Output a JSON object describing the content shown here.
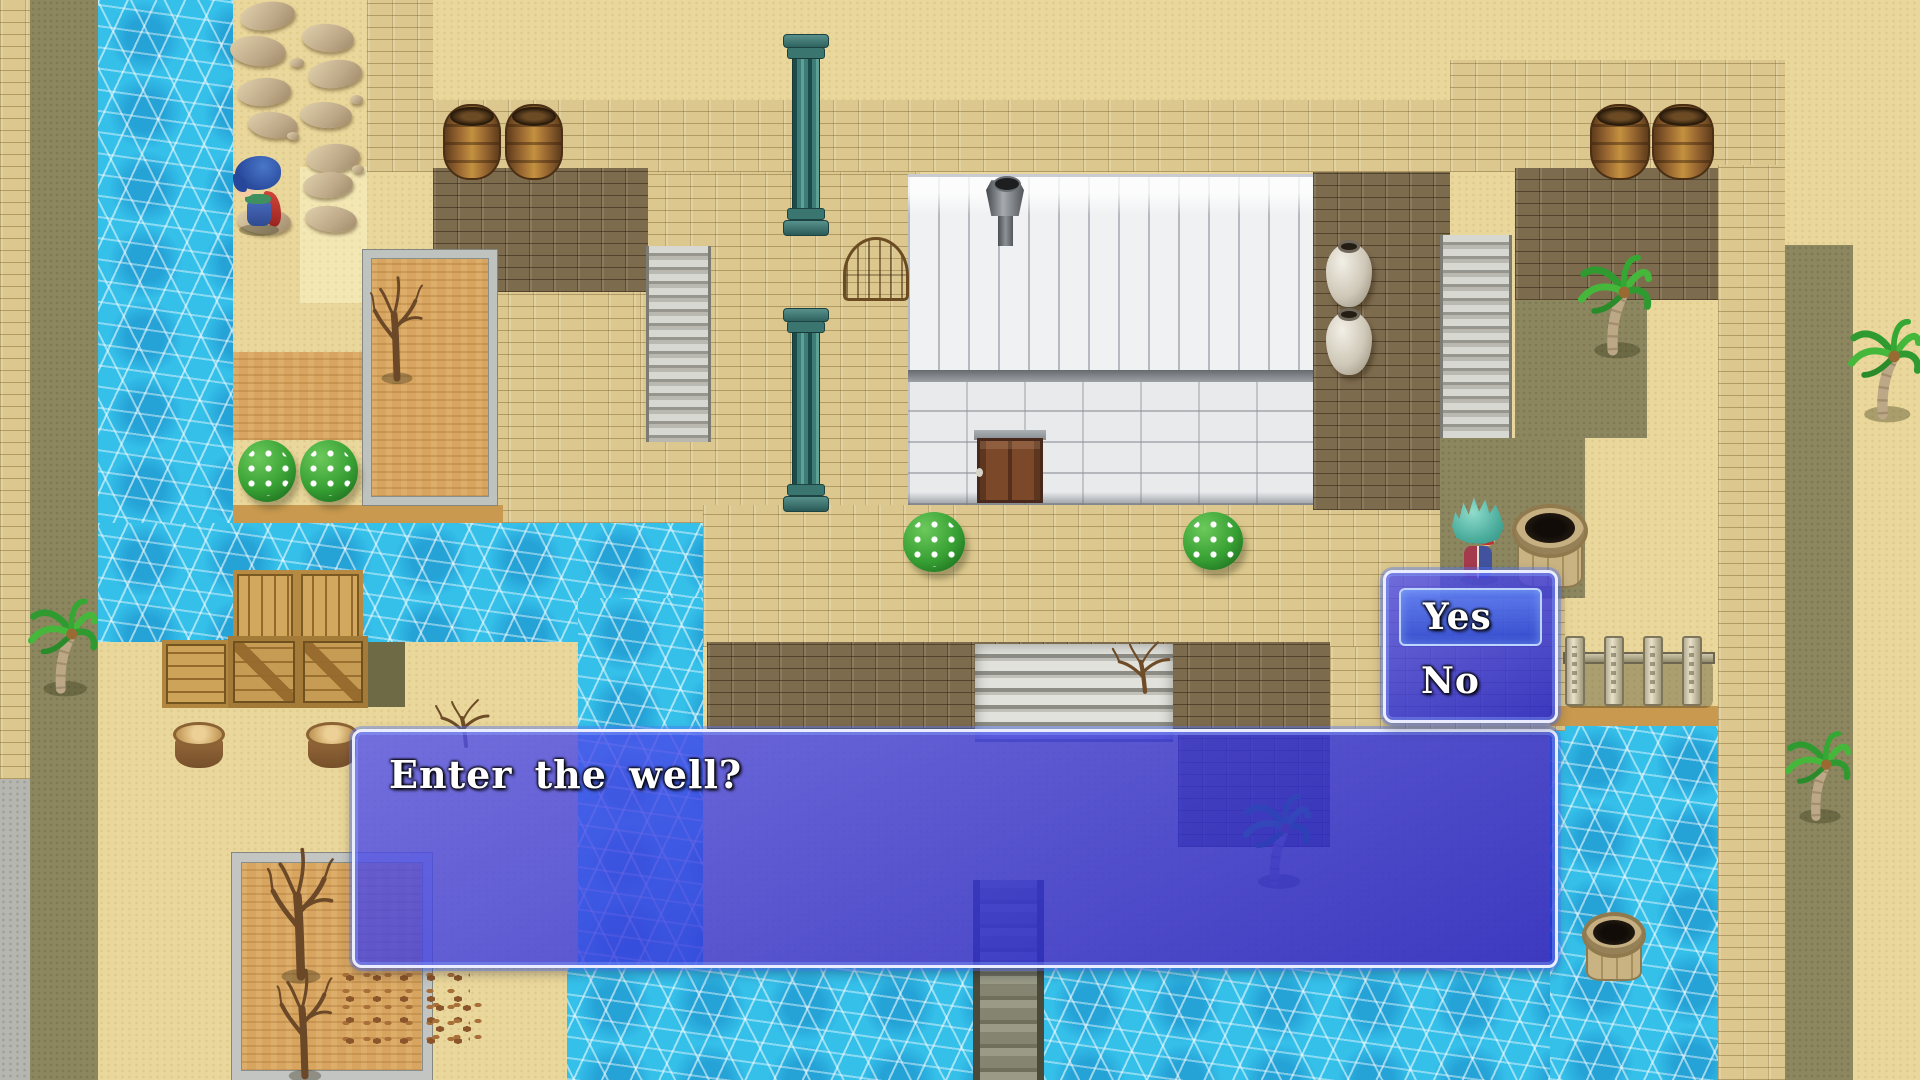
{
  "game": {
    "message_window": {
      "text": "Enter the well?"
    },
    "choice_window": {
      "options": [
        {
          "label": "Yes",
          "selected": true
        },
        {
          "label": "No",
          "selected": false
        }
      ],
      "selected_choice": "Yes"
    }
  },
  "palette": {
    "window_blue": "#3a3ad8",
    "window_border": "#e9edff",
    "selection_blue": "#3f6fd2",
    "water": "#35c0ea",
    "sand": "#ead79b",
    "brick_pavement": "#dcc88e",
    "dark_brick": "#7d6b4e",
    "olive_path": "#8d8760",
    "building_white": "#f0f1f3",
    "door_brown": "#7b482a"
  }
}
